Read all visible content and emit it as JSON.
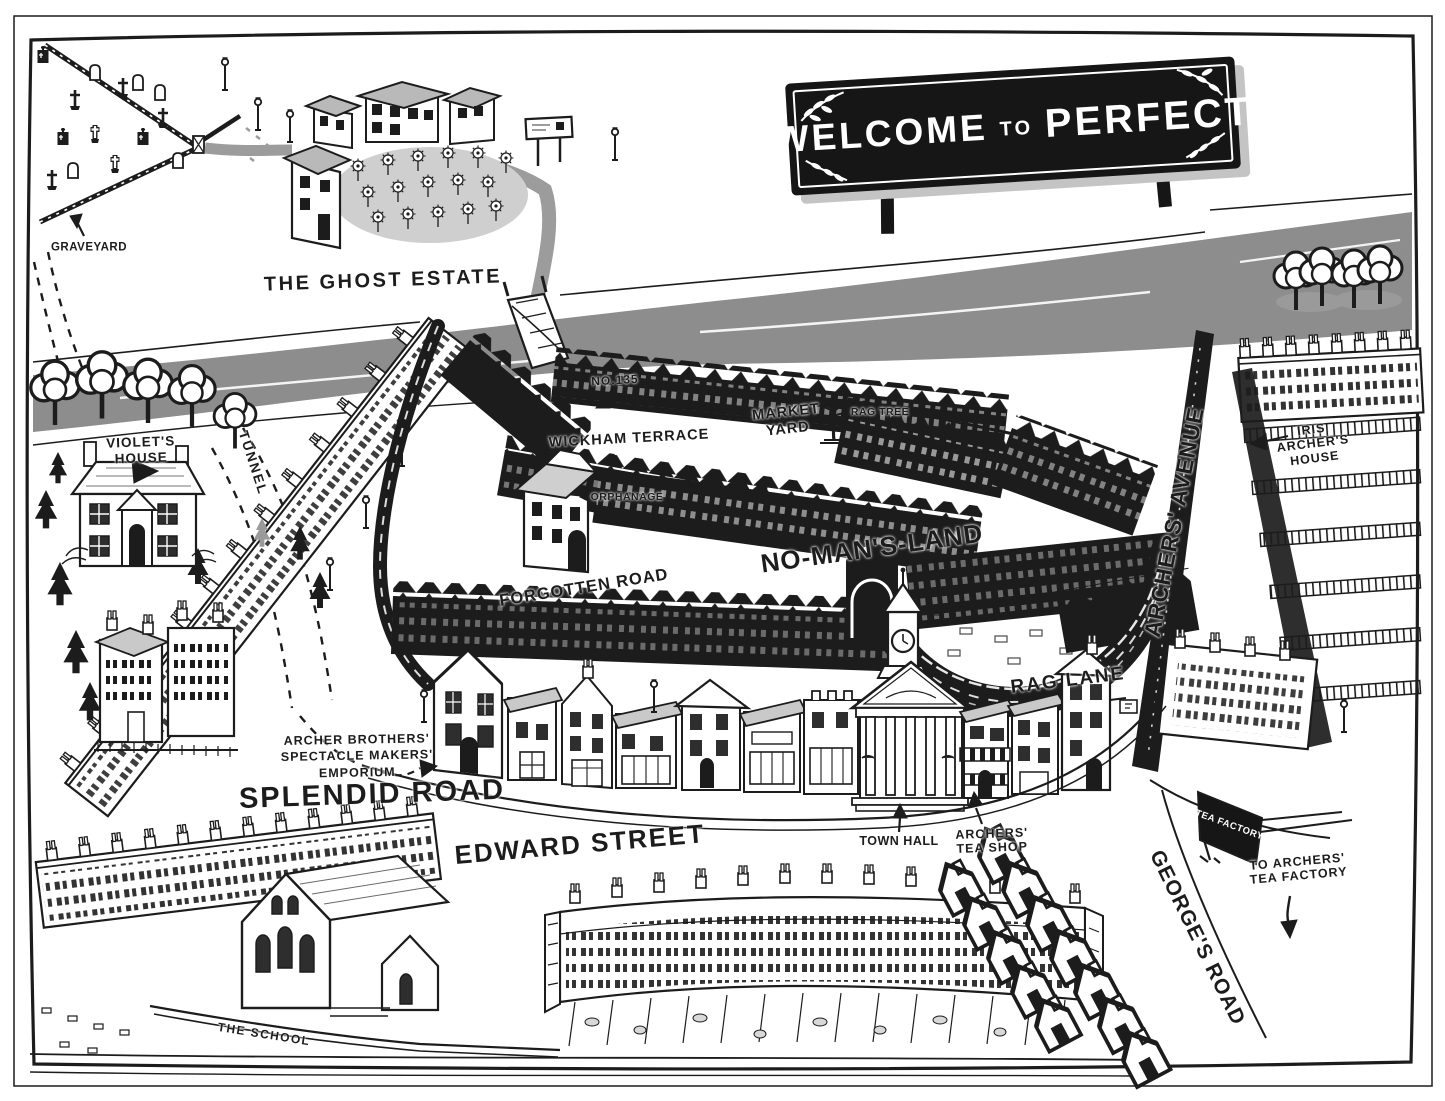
{
  "palette": {
    "ink": "#1c1c1c",
    "paper": "#ffffff",
    "river_gray": "#8d8d8d",
    "shade_gray": "#c4c4c4"
  },
  "sign": {
    "word1": "WELCOME",
    "word2": "TO",
    "word3": "PERFECT"
  },
  "flag": {
    "text": "TEA FACTORY"
  },
  "labels": {
    "graveyard": "GRAVEYARD",
    "ghost_estate": "THE GHOST ESTATE",
    "violets_house": "VIOLET'S\nHOUSE",
    "tunnel": "TUNNEL",
    "no_135": "NO.135",
    "wickham_terrace": "WICKHAM TERRACE",
    "market_yard": "MARKET\nYARD",
    "rag_tree": "RAG TREE",
    "orphanage": "ORPHANAGE",
    "no_mans_land": "NO-MAN'S-LAND",
    "forgotten_road": "FORGOTTEN ROAD",
    "archers_avenue": "ARCHERS' AVENUE",
    "iris_archers_house": "IRIS\nARCHER'S\nHOUSE",
    "rag_lane": "RAG LANE",
    "archer_brothers_emporium": "ARCHER BROTHERS'\nSPECTACLE MAKERS'\nEMPORIUM",
    "splendid_road": "SPLENDID ROAD",
    "edward_street": "EDWARD STREET",
    "town_hall": "TOWN HALL",
    "archers_tea_shop": "ARCHERS'\nTEA SHOP",
    "georges_road": "GEORGE'S ROAD",
    "to_tea_factory": "TO ARCHERS'\nTEA FACTORY",
    "the_school": "THE SCHOOL"
  }
}
